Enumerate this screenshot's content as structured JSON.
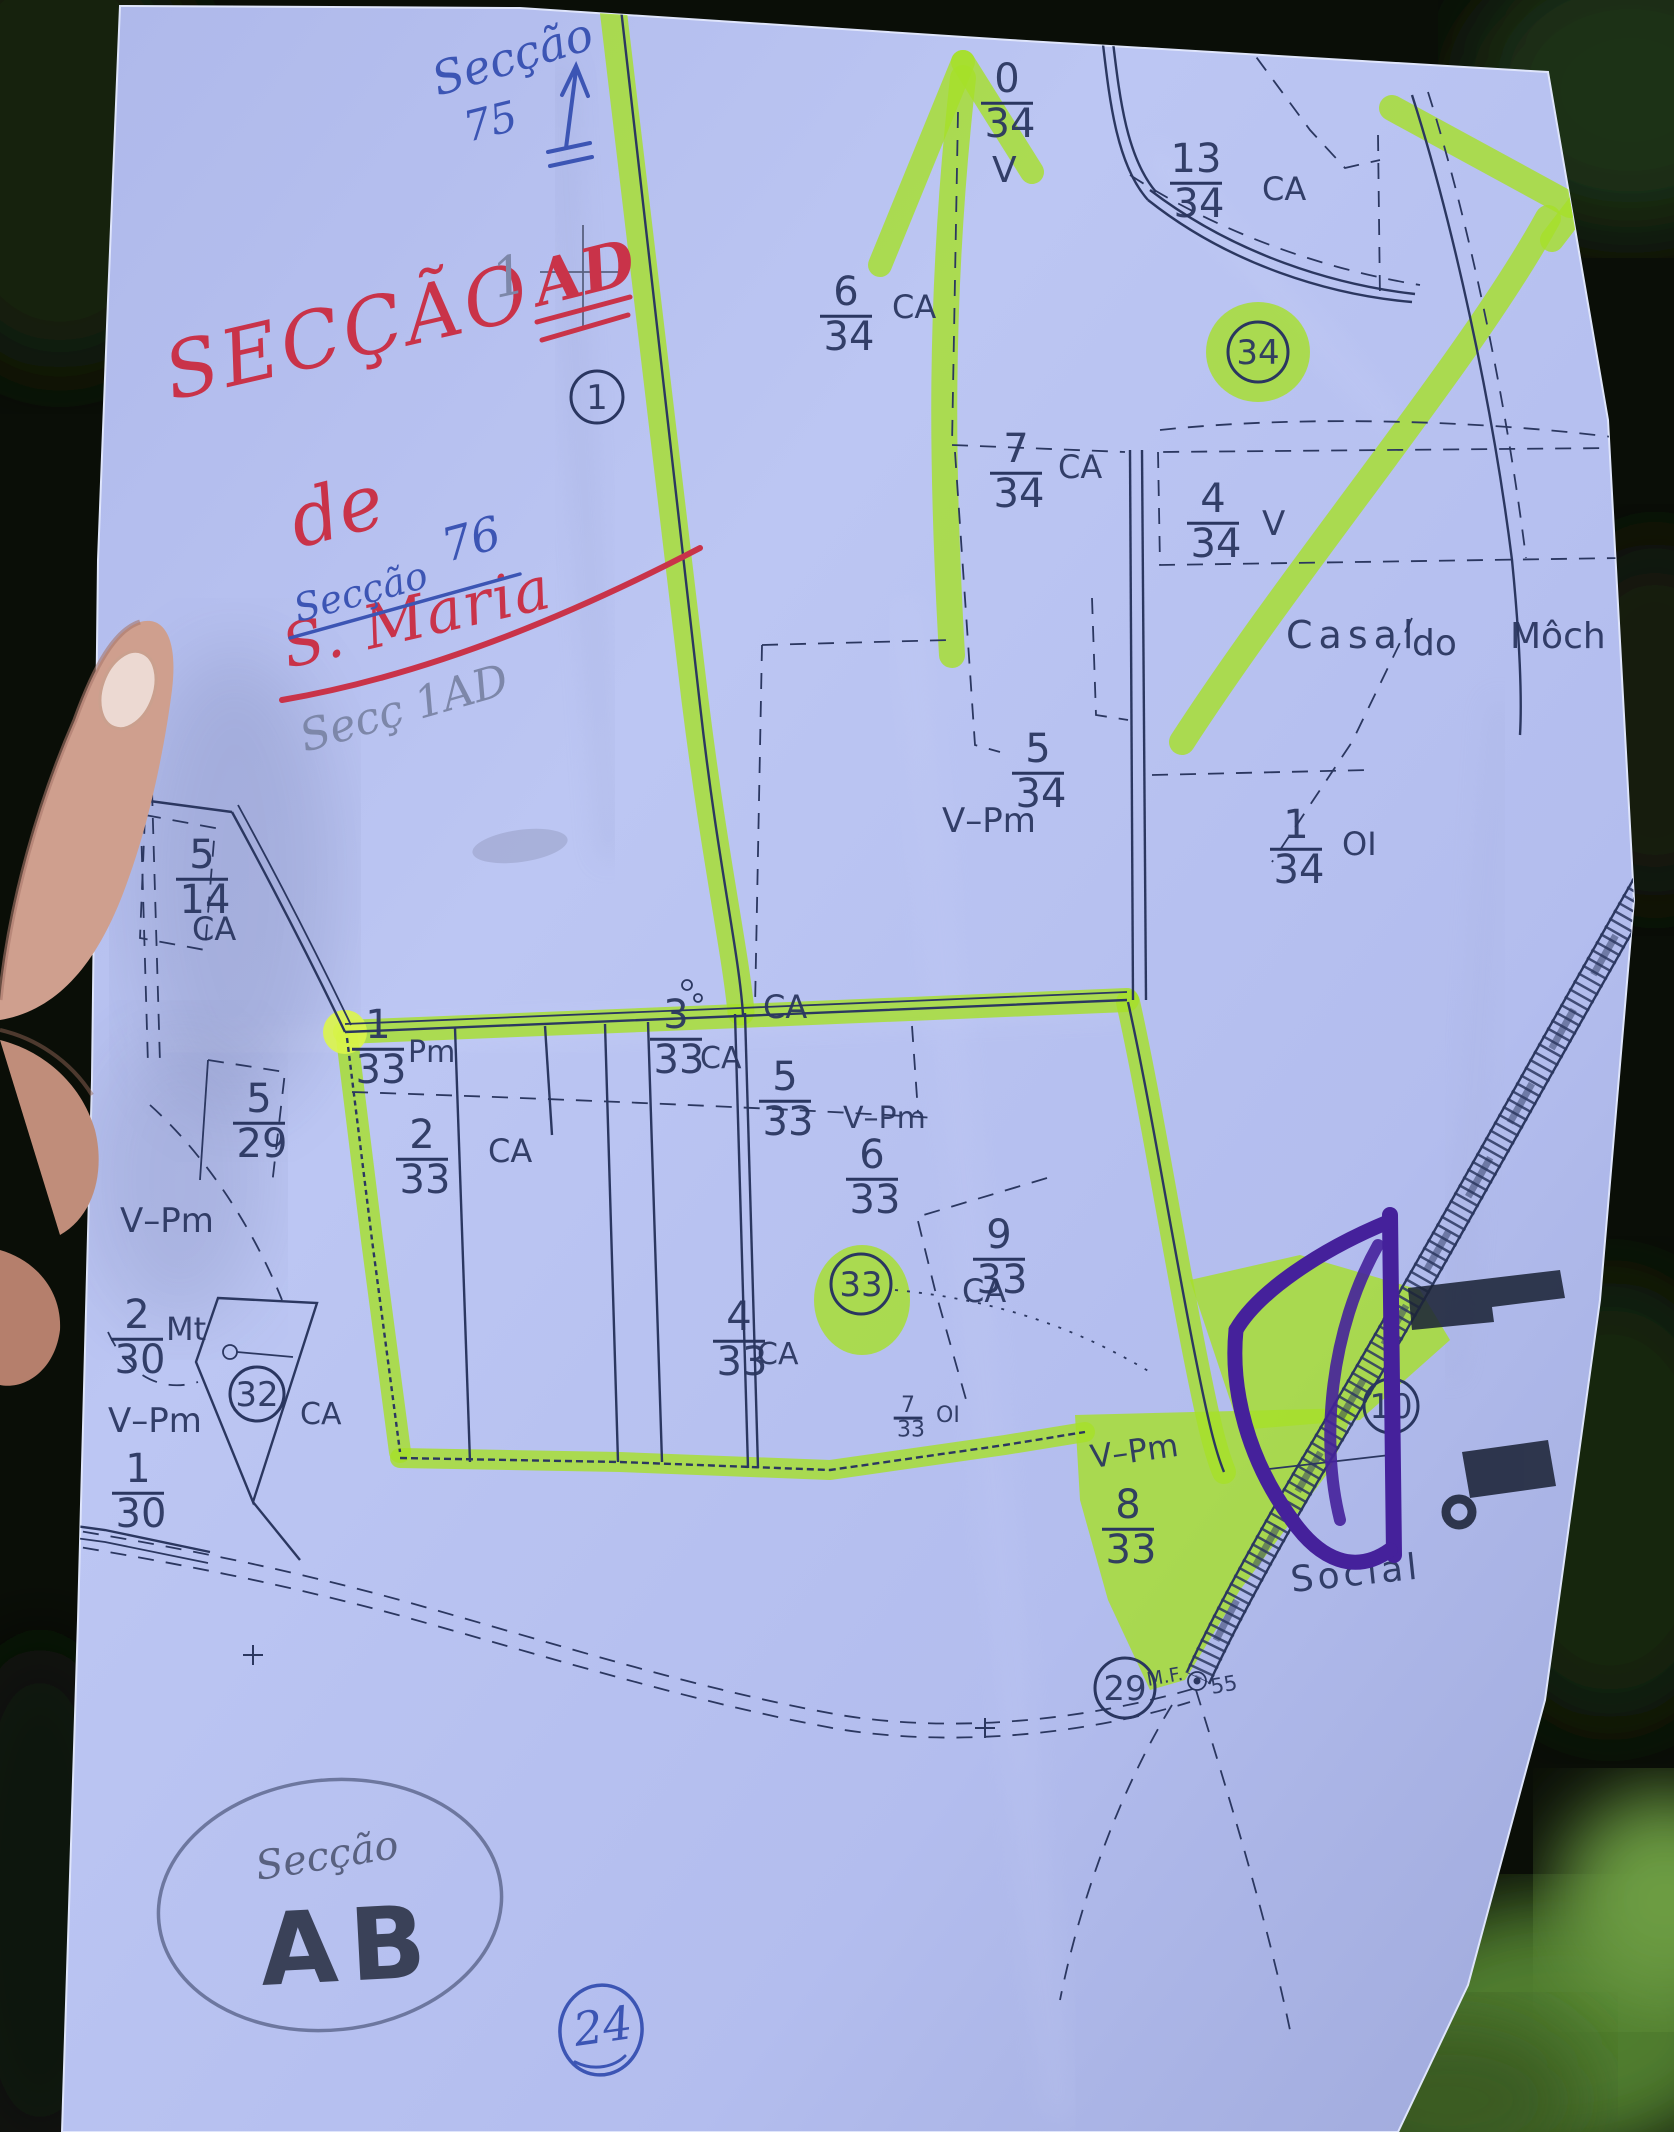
{
  "scene": {
    "paper_color": "#b5bfef",
    "ink_color": "#2b3760",
    "highlighter_color": "#a6e028",
    "purple_marker_color": "#45219b",
    "red_pen_color": "#c93349",
    "blue_pen_color": "#3c55b4"
  },
  "handwriting": {
    "top_note_line1": "Secção",
    "top_note_line2": "75",
    "title_word": "SECÇÃO",
    "title_sup": "1",
    "title_ad": "AD",
    "title_de": "de",
    "title_smaria": "S. Maria",
    "blue_note_word": "Secção",
    "blue_note_num": "76",
    "pencil_note": "Secç 1AD",
    "ab_circle_small": "Secção",
    "ab_circle_big": "AB",
    "blue_circled_num": "24"
  },
  "map_labels": {
    "fractions": [
      {
        "n": "0",
        "d": "34",
        "x": 1007,
        "y": 92
      },
      {
        "n": "13",
        "d": "34",
        "x": 1196,
        "y": 172
      },
      {
        "n": "6",
        "d": "34",
        "x": 846,
        "y": 305
      },
      {
        "n": "7",
        "d": "34",
        "x": 1016,
        "y": 462
      },
      {
        "n": "4",
        "d": "34",
        "x": 1213,
        "y": 512
      },
      {
        "n": "5",
        "d": "34",
        "x": 1038,
        "y": 762
      },
      {
        "n": "1",
        "d": "34",
        "x": 1296,
        "y": 838
      },
      {
        "n": "5",
        "d": "14",
        "x": 202,
        "y": 868
      },
      {
        "n": "5",
        "d": "29",
        "x": 259,
        "y": 1112
      },
      {
        "n": "1",
        "d": "33",
        "x": 378,
        "y": 1038
      },
      {
        "n": "2",
        "d": "33",
        "x": 422,
        "y": 1148
      },
      {
        "n": "3",
        "d": "33",
        "x": 676,
        "y": 1028
      },
      {
        "n": "5",
        "d": "33",
        "x": 785,
        "y": 1090
      },
      {
        "n": "6",
        "d": "33",
        "x": 872,
        "y": 1168
      },
      {
        "n": "9",
        "d": "33",
        "x": 999,
        "y": 1248
      },
      {
        "n": "4",
        "d": "33",
        "x": 739,
        "y": 1330
      },
      {
        "n": "7",
        "d": "33",
        "x": 908,
        "y": 1412,
        "fs": 22
      },
      {
        "n": "2",
        "d": "30",
        "x": 137,
        "y": 1328
      },
      {
        "n": "1",
        "d": "30",
        "x": 138,
        "y": 1482
      },
      {
        "n": "8",
        "d": "33",
        "x": 1128,
        "y": 1518
      }
    ],
    "texts": [
      {
        "t": "V",
        "x": 992,
        "y": 182,
        "fs": 36,
        "name": "label-v"
      },
      {
        "t": "CA",
        "x": 1262,
        "y": 200,
        "fs": 32,
        "name": "label-ca"
      },
      {
        "t": "CA",
        "x": 892,
        "y": 318,
        "fs": 32,
        "name": "label-ca"
      },
      {
        "t": "CA",
        "x": 1058,
        "y": 478,
        "fs": 32,
        "name": "label-ca"
      },
      {
        "t": "V",
        "x": 1262,
        "y": 535,
        "fs": 34,
        "name": "label-v"
      },
      {
        "t": "V–Pm",
        "x": 942,
        "y": 832,
        "fs": 34,
        "name": "label-vpm"
      },
      {
        "t": "OI",
        "x": 1342,
        "y": 855,
        "fs": 32,
        "name": "label-oi"
      },
      {
        "t": "Casal",
        "x": 1286,
        "y": 648,
        "fs": 38,
        "ls": 6,
        "name": "label-casal"
      },
      {
        "t": "do",
        "x": 1412,
        "y": 655,
        "fs": 36,
        "name": "label-do"
      },
      {
        "t": "Môch",
        "x": 1510,
        "y": 648,
        "fs": 36,
        "name": "label-moch"
      },
      {
        "t": "CA",
        "x": 192,
        "y": 940,
        "fs": 32,
        "name": "label-ca"
      },
      {
        "t": "Pm",
        "x": 408,
        "y": 1062,
        "fs": 30,
        "name": "label-pm"
      },
      {
        "t": "CA",
        "x": 763,
        "y": 1018,
        "fs": 32,
        "name": "label-ca"
      },
      {
        "t": "CA",
        "x": 700,
        "y": 1068,
        "fs": 30,
        "name": "label-ca"
      },
      {
        "t": "CA",
        "x": 488,
        "y": 1162,
        "fs": 32,
        "name": "label-ca"
      },
      {
        "t": "V–Pm",
        "x": 843,
        "y": 1128,
        "fs": 30,
        "name": "label-vpm"
      },
      {
        "t": "CA",
        "x": 962,
        "y": 1302,
        "fs": 32,
        "name": "label-ca"
      },
      {
        "t": "CA",
        "x": 757,
        "y": 1364,
        "fs": 30,
        "name": "label-ca"
      },
      {
        "t": "OI",
        "x": 936,
        "y": 1422,
        "fs": 22,
        "name": "label-oi"
      },
      {
        "t": "Mt",
        "x": 166,
        "y": 1340,
        "fs": 32,
        "name": "label-mt"
      },
      {
        "t": "CA",
        "x": 300,
        "y": 1424,
        "fs": 30,
        "name": "label-ca"
      },
      {
        "t": "V–Pm",
        "x": 120,
        "y": 1232,
        "fs": 34,
        "name": "label-vpm"
      },
      {
        "t": "V–Pm",
        "x": 108,
        "y": 1432,
        "fs": 34,
        "name": "label-vpm"
      },
      {
        "t": "V–Pm",
        "x": 1092,
        "y": 1468,
        "fs": 32,
        "rot": -8,
        "name": "label-vpm"
      },
      {
        "t": "Social",
        "x": 1292,
        "y": 1592,
        "fs": 36,
        "ls": 4,
        "rot": -6,
        "name": "label-social"
      },
      {
        "t": "M.F.",
        "x": 1148,
        "y": 1686,
        "fs": 19,
        "rot": -10,
        "name": "label-mf"
      },
      {
        "t": "55",
        "x": 1212,
        "y": 1694,
        "fs": 21,
        "rot": -10,
        "name": "label-55"
      }
    ],
    "circles": [
      {
        "v": "1",
        "x": 597,
        "y": 397,
        "r": 26
      },
      {
        "v": "34",
        "x": 1258,
        "y": 352,
        "r": 30
      },
      {
        "v": "33",
        "x": 861,
        "y": 1284,
        "r": 30
      },
      {
        "v": "32",
        "x": 257,
        "y": 1394,
        "r": 27
      },
      {
        "v": "29",
        "x": 1125,
        "y": 1688,
        "r": 30
      },
      {
        "v": "10",
        "x": 1391,
        "y": 1406,
        "r": 27
      }
    ]
  }
}
